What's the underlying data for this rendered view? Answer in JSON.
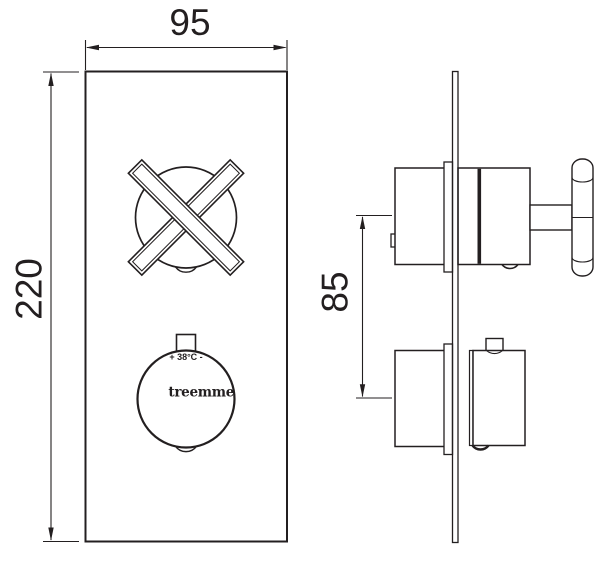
{
  "dimensions": {
    "plate_width_mm": "95",
    "plate_height_mm": "220",
    "handle_spacing_mm": "85"
  },
  "thermostat_knob": {
    "temperature_label": "+ 38°C -",
    "brand": "treemme"
  },
  "colors": {
    "line": "#231f20",
    "background": "#ffffff"
  }
}
